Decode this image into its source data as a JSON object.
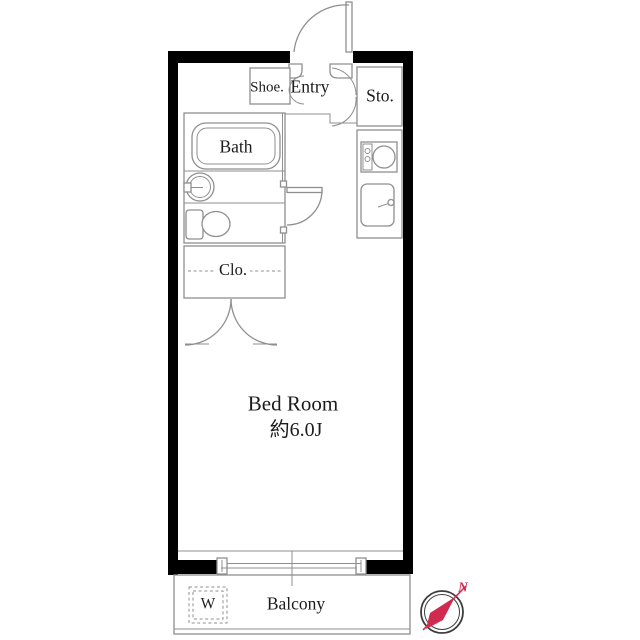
{
  "floorplan": {
    "rooms": {
      "shoe_cabinet": {
        "label": "Shoe."
      },
      "entry": {
        "label": "Entry"
      },
      "storage": {
        "label": "Sto."
      },
      "bath": {
        "label": "Bath"
      },
      "closet": {
        "label": "Clo."
      },
      "bedroom": {
        "label": "Bed Room",
        "size": "約6.0J"
      },
      "balcony": {
        "label": "Balcony",
        "washer_label": "W"
      }
    },
    "compass": {
      "label": "N"
    },
    "colors": {
      "wall": "#000000",
      "line": "#8f8f8f",
      "text": "#1c1c1c",
      "accent": "#d02a4e"
    }
  }
}
